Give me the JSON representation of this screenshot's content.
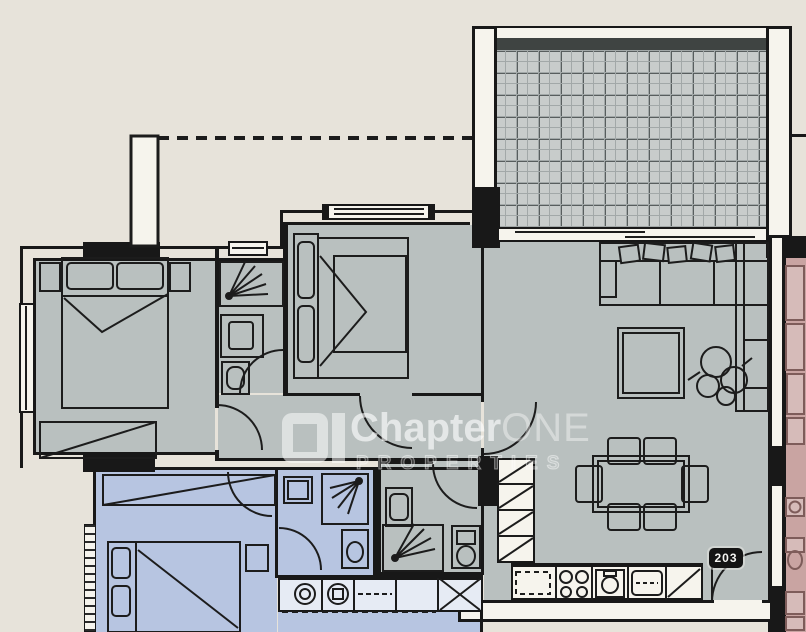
{
  "watermark": {
    "logo": "chapter-one-logo",
    "brand_primary": "Chapter",
    "brand_secondary": "ONE",
    "tagline": "PROPERTIES"
  },
  "unit": {
    "number": "203"
  },
  "colors": {
    "background": "#e7e3da",
    "room_gray": "#b9c0bf",
    "room_blue": "#b7c5e1",
    "room_pink": "#c9a4a2",
    "wall_black": "#181818",
    "white": "#f6f4ed",
    "tile_base": "#c8cccb",
    "tile_line_minor": "#a2a8a8",
    "tile_line_major": "#585e5e",
    "balcony_edge": "#3f4442",
    "label_bg": "#141414",
    "label_text": "#f5f5f2",
    "blue_counter": "#e6ebf4",
    "pink_stroke": "#7e5c5a",
    "line_dark": "#1c1c1c"
  }
}
